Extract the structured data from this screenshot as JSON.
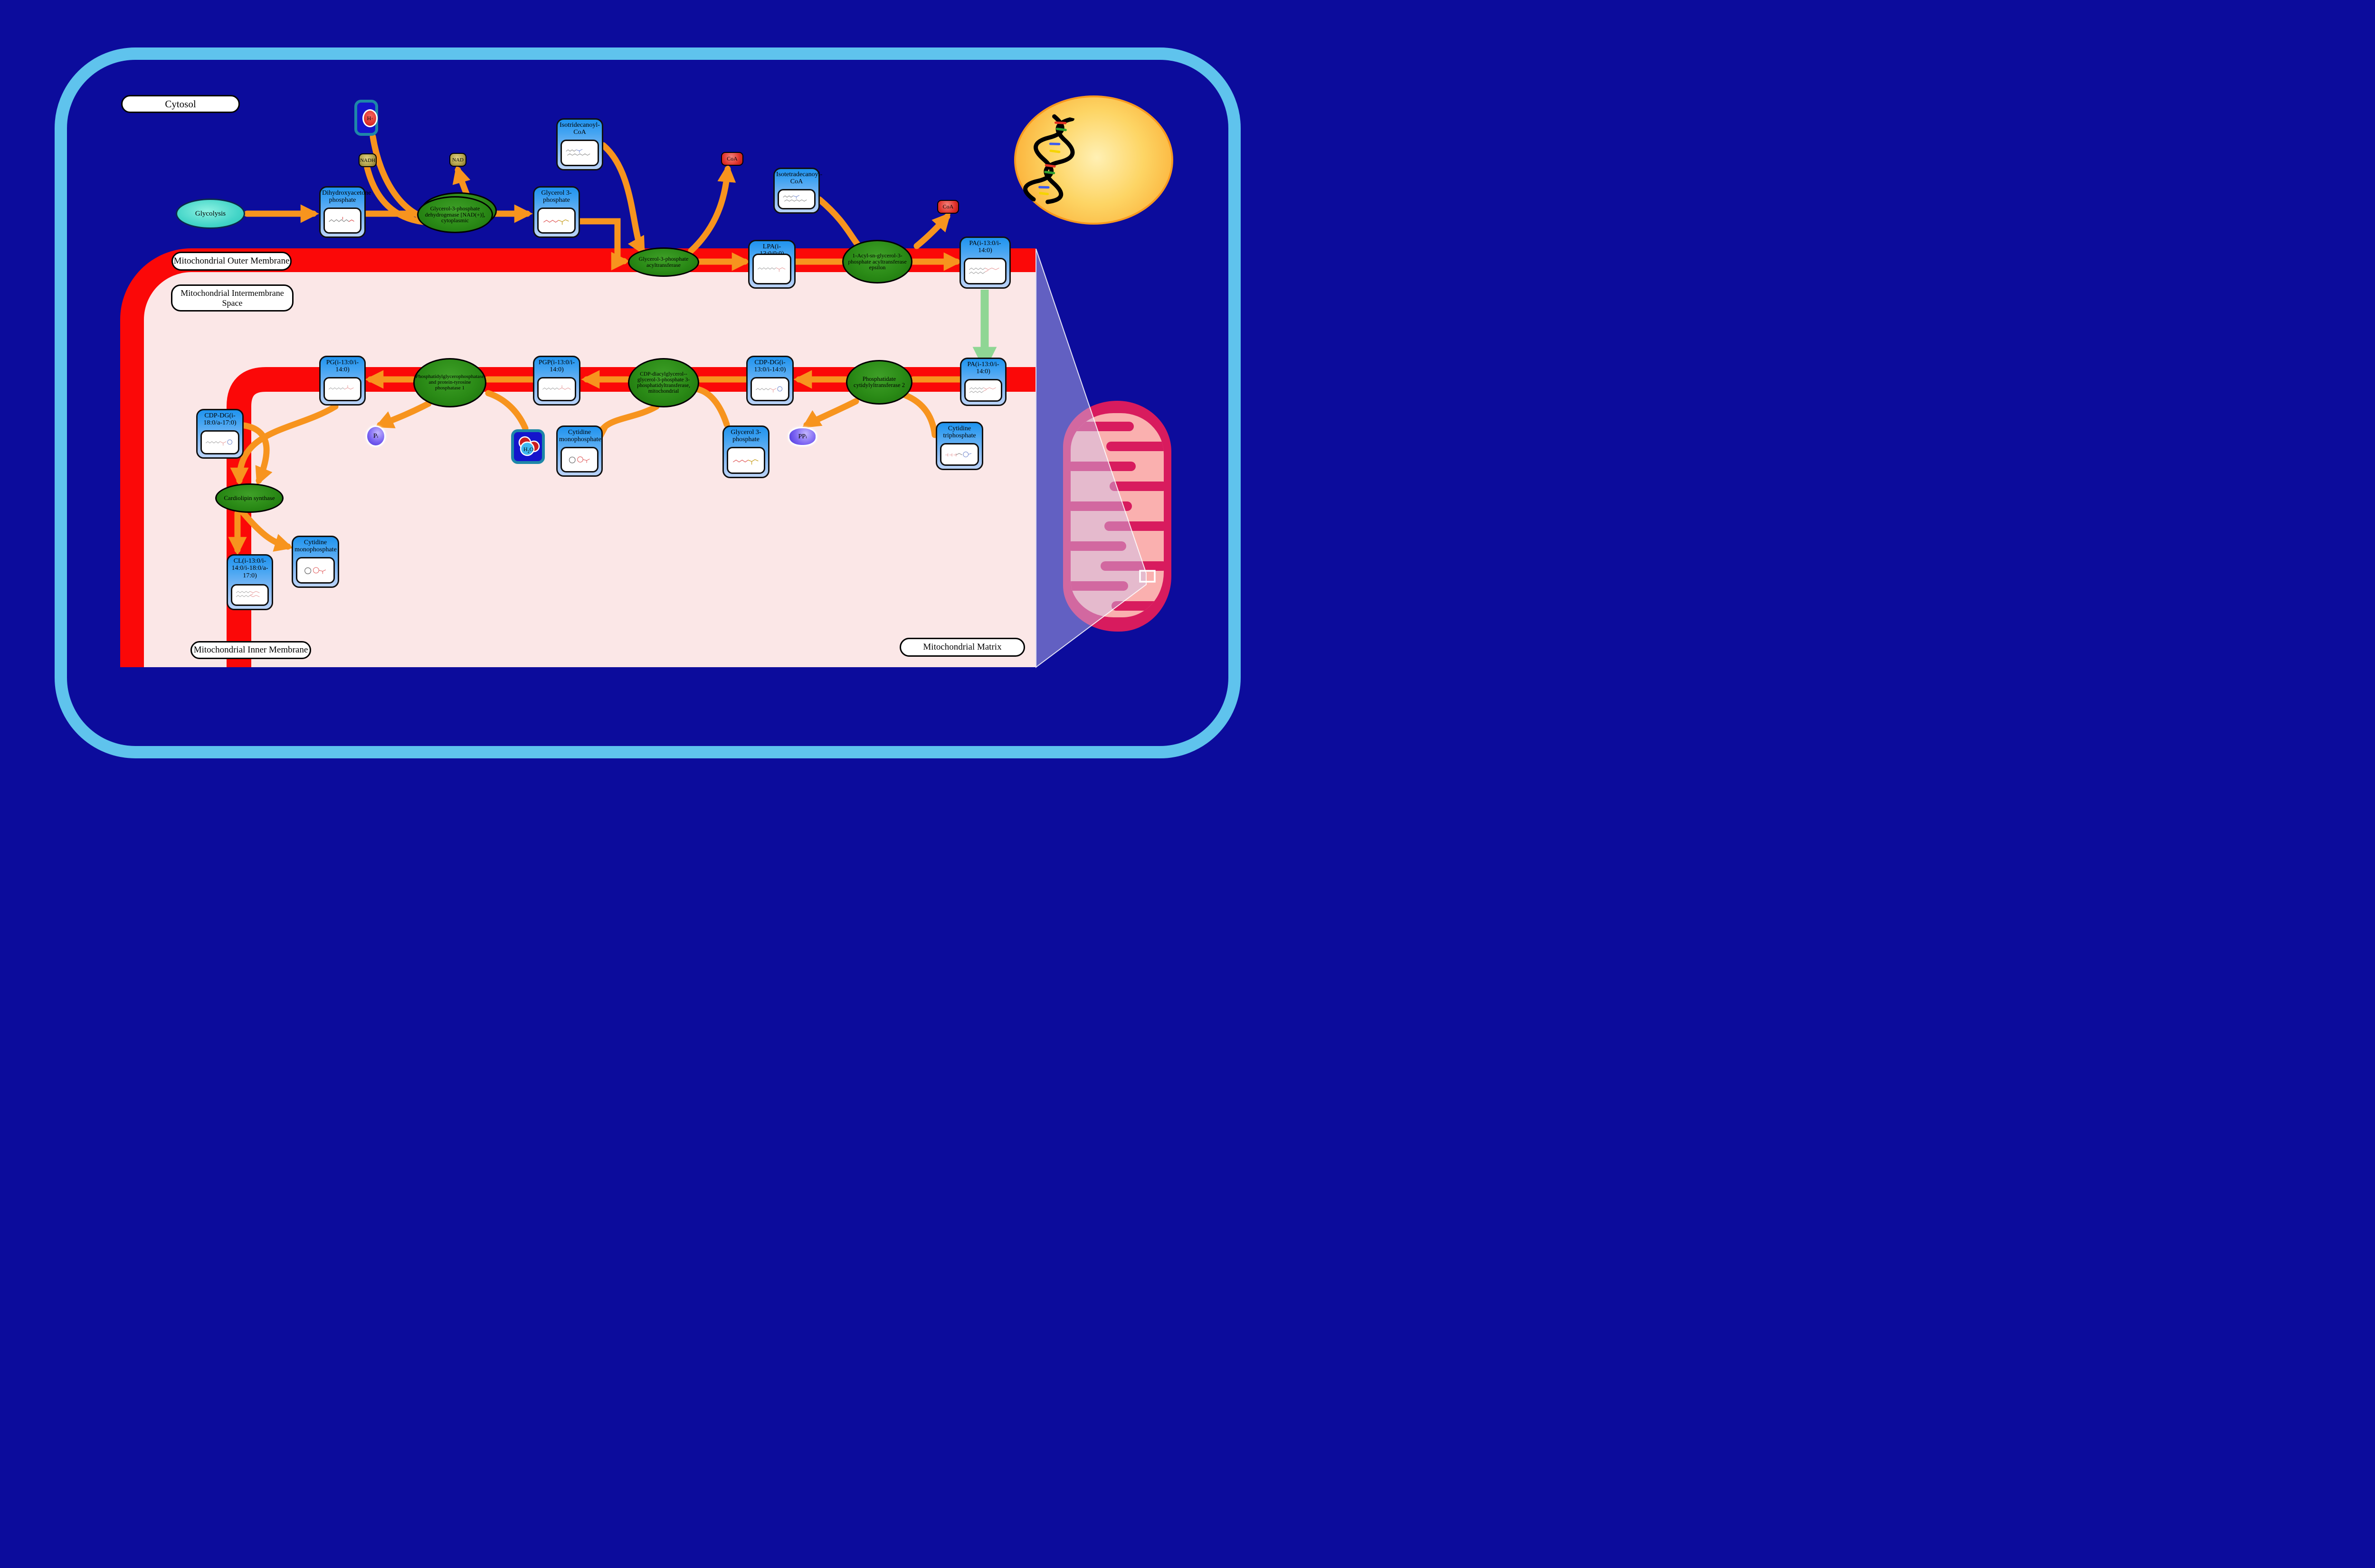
{
  "compartments": {
    "cytosol": "Cytosol",
    "outer_membrane": "Mitochondrial Outer Membrane",
    "intermembrane": "Mitochondrial Intermembrane Space",
    "inner_membrane": "Mitochondrial Inner Membrane",
    "matrix": "Mitochondrial Matrix"
  },
  "pathway": {
    "glycolysis": "Glycolysis"
  },
  "enzymes": {
    "gpd": "Glycerol-3-phosphate dehydrogenase [NAD(+)], cytoplasmic",
    "gpat": "Glycerol-3-phosphate acyltransferase",
    "agpat": "1-Acyl-sn-glycerol-3-phosphate acyltransferase epsilon",
    "pcyt2": "Phosphatidate cytidylyltransferase 2",
    "pgs1": "CDP-diacylglycerol--glycerol-3-phosphate 3-phosphatidyltransferase, mitochondrial",
    "ptpmt1": "Phosphatidylglycerophosphatase and protein-tyrosine phosphatase 1",
    "crls1": "Cardiolipin synthase"
  },
  "metabolites": {
    "dhap": "Dihydroxyacetone phosphate",
    "g3p": "Glycerol 3-phosphate",
    "iso13coa": "Isotridecanoyl-CoA",
    "iso14coa": "Isotetradecanoyl-CoA",
    "lpa": "LPA(i-13:0/0:0)",
    "pa": "PA(i-13:0/i-14:0)",
    "cdpdg": "CDP-DG(i-13:0/i-14:0)",
    "pgp": "PGP(i-13:0/i-14:0)",
    "pg": "PG(i-13:0/i-14:0)",
    "cdpdg2": "CDP-DG(i-18:0/a-17:0)",
    "cl": "CL(i-13:0/i-14:0/i-18:0/a-17:0)",
    "cmp": "Cytidine monophosphate",
    "ctp": "Cytidine triphosphate"
  },
  "small": {
    "nadh": "NADH",
    "nad": "NAD",
    "h_base": "H",
    "h_sup": "+",
    "coa": "CoA",
    "p_base": "P",
    "p_sub": "i",
    "pp_base": "PP",
    "pp_sub": "i",
    "h2o_h": "H",
    "h2o_2": "2",
    "h2o_o": "O"
  },
  "colors": {
    "background_navy": "#0c0c9c",
    "cell_border_blue": "#5fc3ed",
    "membrane_red": "#fb0808",
    "canvas_pink": "#fbe7e7",
    "arrow_orange": "#f7941e",
    "arrow_green": "#8fd694",
    "node_blue": "#2196f3",
    "enzyme_green": "#2a8a16",
    "mito_crimson": "#d81b5e",
    "mito_pink": "#fab0af",
    "nucleus_yellow": "#fdd565"
  }
}
